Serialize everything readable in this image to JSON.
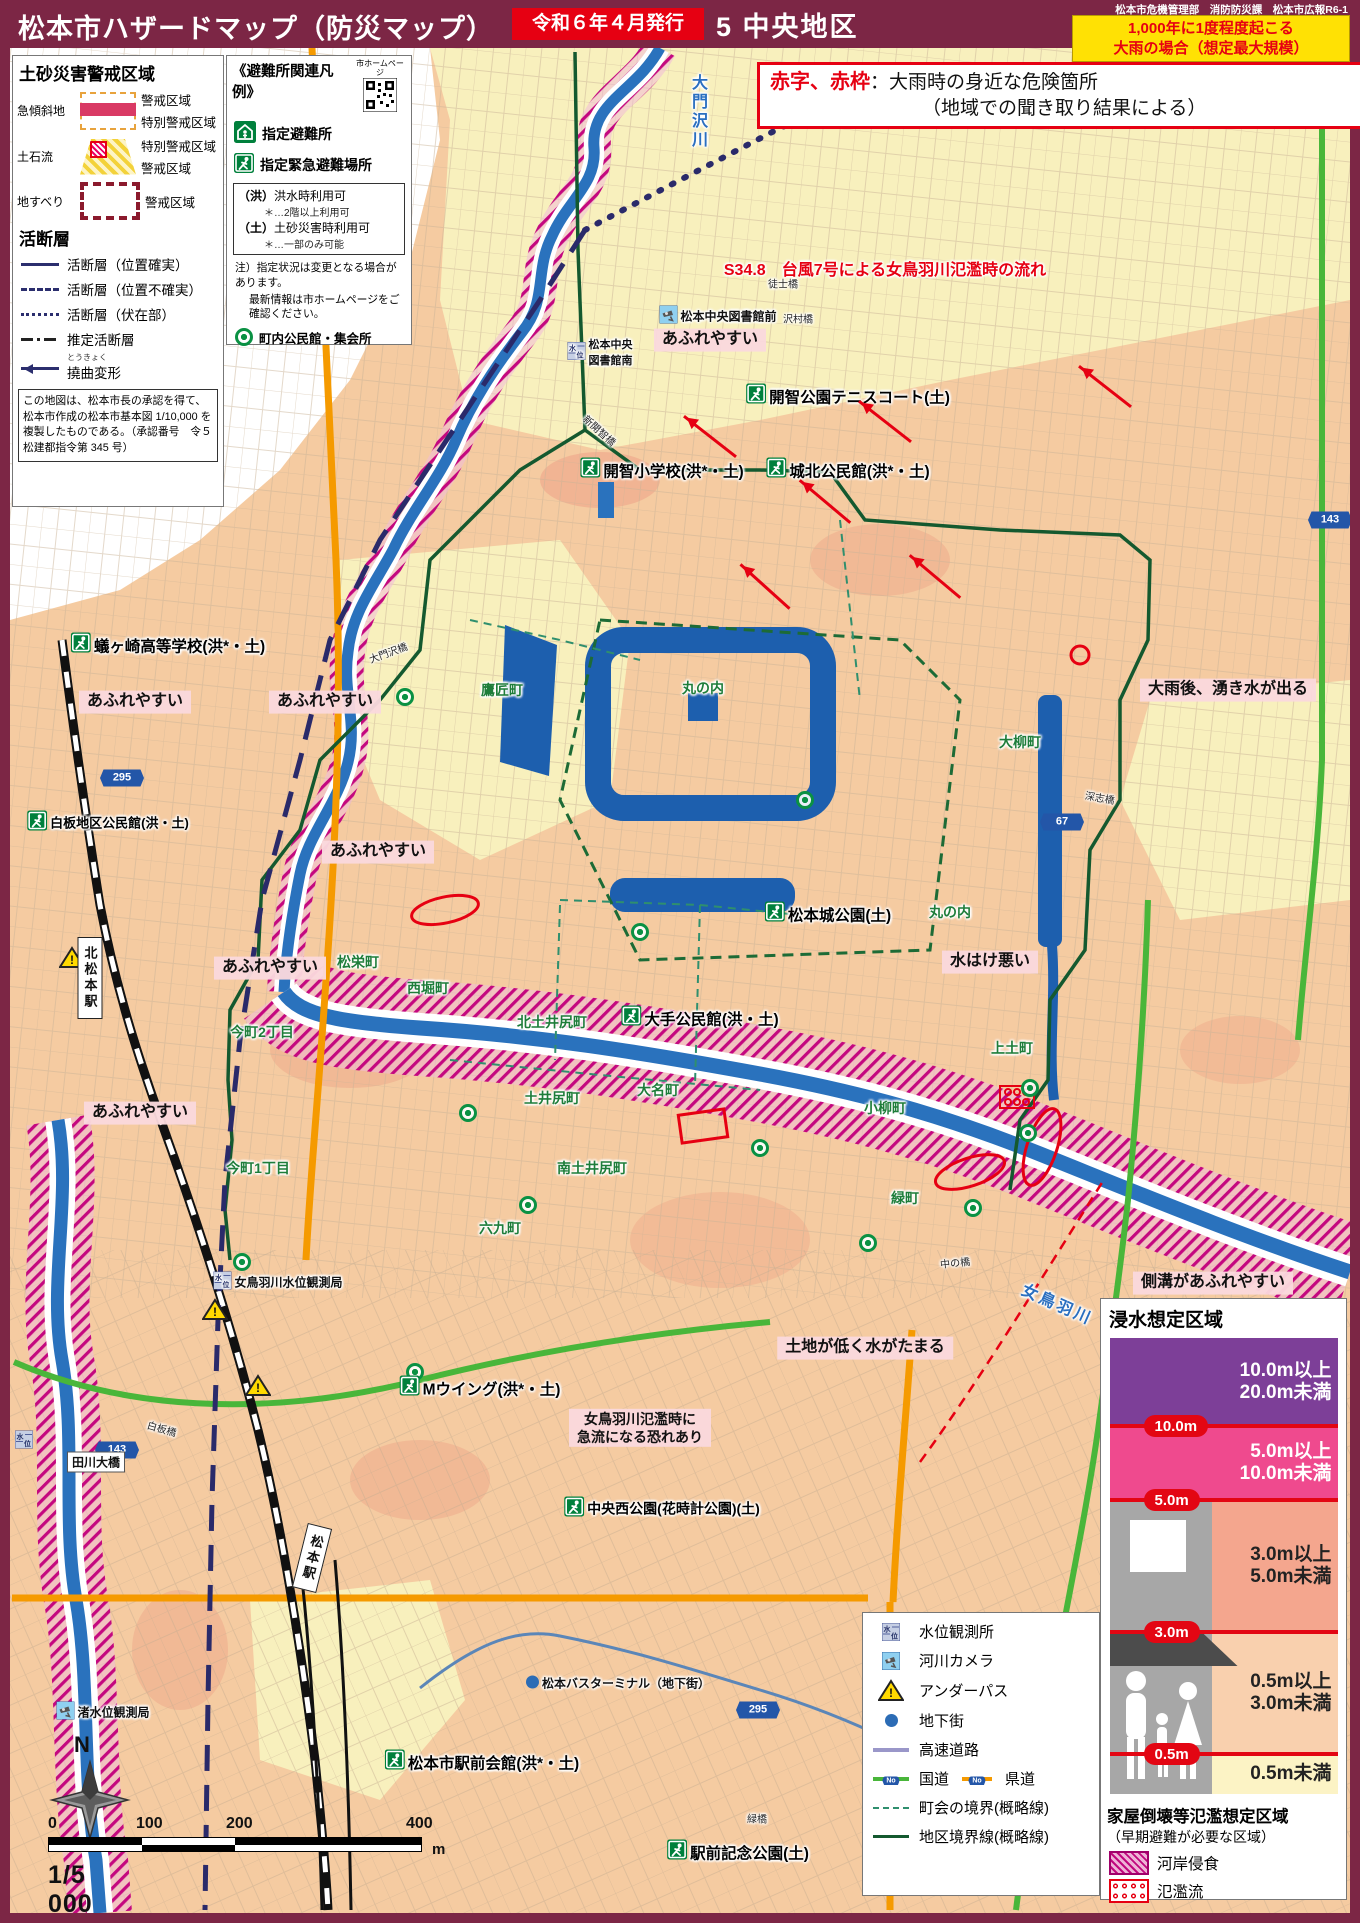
{
  "header": {
    "title": "松本市ハザードマップ（防災マップ）",
    "issue": "令和６年４月発行",
    "district": "5 中央地区",
    "dept": "松本市危機管理部　消防防災課　松本市広報R6-1",
    "scenario_line1": "1,000年に1度程度起こる",
    "scenario_line2": "大雨の場合（想定最大規模）"
  },
  "red_note": {
    "lead": "赤字、赤枠",
    "body": "：大雨時の身近な危険箇所",
    "line2": "（地域での聞き取り結果による）"
  },
  "legend_sediment": {
    "title": "土砂災害警戒区域",
    "rows": [
      {
        "label": "急傾斜地",
        "swatch": "steep",
        "items": [
          "警戒区域",
          "特別警戒区域"
        ]
      },
      {
        "label": "土石流",
        "swatch": "debris",
        "items": [
          "特別警戒区域",
          "警戒区域"
        ]
      },
      {
        "label": "地すべり",
        "swatch": "slide",
        "items": [
          "警戒区域"
        ]
      }
    ],
    "fault_title": "活断層",
    "fault_items": [
      {
        "style": "solid",
        "label": "活断層（位置確実）"
      },
      {
        "style": "dashed",
        "label": "活断層（位置不確実）"
      },
      {
        "style": "dotted",
        "label": "活断層（伏在部）"
      },
      {
        "style": "dashdot",
        "label": "推定活断層"
      },
      {
        "style": "arrow",
        "label": "撓曲変形",
        "ruby": "とうきょく"
      }
    ],
    "note": "この地図は、松本市長の承認を得て、松本市作成の松本市基本図 1/10,000 を複製したものである。（承認番号　令５松建都指令第 345 号）"
  },
  "legend_shelter": {
    "title": "《避難所関連凡例》",
    "qr_label": "市ホームページ",
    "items": [
      {
        "icon": "house",
        "label": "指定避難所"
      },
      {
        "icon": "shelter",
        "label": "指定緊急避難場所"
      }
    ],
    "usage": [
      {
        "key": "（洪）",
        "label": "洪水時利用可",
        "note": "＊…2階以上利用可"
      },
      {
        "key": "（土）",
        "label": "土砂災害時利用可",
        "note": "＊…一部のみ可能"
      }
    ],
    "note1": "注）指定状況は変更となる場合があります。",
    "note2": "最新情報は市ホームページをご確認ください。",
    "community_label": "町内公民館・集会所"
  },
  "flood_legend": {
    "title": "浸水想定区域",
    "bands": [
      {
        "color": "#7d3f98",
        "h": 88,
        "text1": "10.0m以上",
        "text2": "20.0m未満",
        "dark": false,
        "marker": "10.0m"
      },
      {
        "color": "#ef4a8e",
        "h": 74,
        "text1": "5.0m以上",
        "text2": "10.0m未満",
        "dark": false,
        "marker": "5.0m"
      },
      {
        "color": "#f4a68e",
        "h": 132,
        "text1": "3.0m以上",
        "text2": "5.0m未満",
        "dark": true,
        "marker": "3.0m"
      },
      {
        "color": "#f9d0ae",
        "h": 122,
        "text1": "0.5m以上",
        "text2": "3.0m未満",
        "dark": true,
        "marker": "0.5m"
      },
      {
        "color": "#fcf3c5",
        "h": 40,
        "text1": "0.5m未満",
        "text2": "",
        "dark": true
      }
    ],
    "collapse_title": "家屋倒壊等氾濫想定区域",
    "collapse_sub": "（早期避難が必要な区域）",
    "collapse_items": [
      {
        "swatch": "erosion",
        "label": "河岸侵食"
      },
      {
        "swatch": "flow",
        "label": "氾濫流"
      }
    ]
  },
  "symbol_legend": {
    "rows": [
      {
        "icon": "water-level",
        "label": "水位観測所"
      },
      {
        "icon": "river-camera",
        "label": "河川カメラ"
      },
      {
        "icon": "underpass",
        "label": "アンダーパス"
      },
      {
        "icon": "underground",
        "label": "地下街"
      },
      {
        "icon": "expressway",
        "label": "高速道路"
      },
      {
        "icon": "national-route",
        "label": "国道",
        "icon2": "prefectural-route",
        "label2": "県道"
      },
      {
        "icon": "town-boundary",
        "label": "町会の境界(概略線)"
      },
      {
        "icon": "district-boundary",
        "label": "地区境界線(概略線)"
      }
    ]
  },
  "scale": {
    "ticks": [
      "0",
      "100",
      "200",
      "400"
    ],
    "unit": "m",
    "ratio": "1/5 000",
    "north": "N"
  },
  "map_labels": [
    {
      "k": "red",
      "t": "S34.8　台風7号による女鳥羽川氾濫時の流れ",
      "x": 885,
      "y": 268
    },
    {
      "k": "pink",
      "t": "あふれやすい",
      "x": 710,
      "y": 340
    },
    {
      "k": "pink",
      "t": "あふれやすい",
      "x": 135,
      "y": 702
    },
    {
      "k": "pink",
      "t": "あふれやすい",
      "x": 325,
      "y": 702
    },
    {
      "k": "pink",
      "t": "あふれやすい",
      "x": 378,
      "y": 852
    },
    {
      "k": "pink",
      "t": "あふれやすい",
      "x": 270,
      "y": 968
    },
    {
      "k": "pink",
      "t": "あふれやすい",
      "x": 140,
      "y": 1113
    },
    {
      "k": "pink",
      "t": "大雨後、湧き水が出る",
      "x": 1228,
      "y": 690
    },
    {
      "k": "pink",
      "t": "水はけ悪い",
      "x": 990,
      "y": 962
    },
    {
      "k": "pink",
      "t": "側溝があふれやすい",
      "x": 1213,
      "y": 1283
    },
    {
      "k": "pink",
      "t": "土地が低く水がたまる",
      "x": 865,
      "y": 1348
    },
    {
      "k": "pink",
      "t": "女鳥羽川氾濫時に\n急流になる恐れあり",
      "x": 640,
      "y": 1428,
      "s": 14
    },
    {
      "k": "shelter",
      "icon": "shelter",
      "t": "開智公園テニスコート(土)",
      "x": 848,
      "y": 396
    },
    {
      "k": "shelter",
      "icon": "shelter",
      "t": "開智小学校(洪*・土)",
      "x": 662,
      "y": 470
    },
    {
      "k": "shelter",
      "icon": "shelter",
      "t": "城北公民館(洪*・土)",
      "x": 848,
      "y": 470
    },
    {
      "k": "shelter",
      "icon": "shelter",
      "t": "蟻ヶ崎高等学校(洪*・土)",
      "x": 168,
      "y": 645
    },
    {
      "k": "shelter",
      "icon": "shelter",
      "t": "白板地区公民館(洪・土)",
      "x": 108,
      "y": 822,
      "s": 13
    },
    {
      "k": "shelter",
      "icon": "shelter",
      "t": "松本城公園(土)",
      "x": 828,
      "y": 914
    },
    {
      "k": "shelter",
      "icon": "shelter",
      "t": "大手公民館(洪・土)",
      "x": 700,
      "y": 1018
    },
    {
      "k": "shelter",
      "icon": "shelter",
      "t": "Mウイング(洪*・土)",
      "x": 480,
      "y": 1388
    },
    {
      "k": "shelter",
      "icon": "shelter",
      "t": "中央西公園(花時計公園)(土)",
      "x": 662,
      "y": 1508,
      "s": 14
    },
    {
      "k": "shelter",
      "icon": "shelter",
      "t": "松本市駅前会館(洪*・土)",
      "x": 482,
      "y": 1762
    },
    {
      "k": "shelter",
      "icon": "shelter",
      "t": "駅前記念公園(土)",
      "x": 738,
      "y": 1852
    },
    {
      "k": "poi",
      "icon": "camera",
      "t": "松本中央図書館前",
      "x": 718,
      "y": 316
    },
    {
      "k": "poi",
      "icon": "gauge",
      "t": "松本中央\n図書館南",
      "x": 600,
      "y": 352,
      "s": 11
    },
    {
      "k": "poi",
      "icon": "gauge",
      "t": "女鳥羽川水位観測局",
      "x": 278,
      "y": 1282
    },
    {
      "k": "poi",
      "icon": "camera",
      "t": "渚水位観測局",
      "x": 103,
      "y": 1712
    },
    {
      "k": "poi",
      "icon": "dot",
      "t": "松本バスターミナル（地下街）",
      "x": 618,
      "y": 1683
    },
    {
      "k": "town",
      "t": "鷹匠町",
      "x": 502,
      "y": 690
    },
    {
      "k": "town",
      "t": "丸の内",
      "x": 703,
      "y": 688
    },
    {
      "k": "town",
      "t": "大柳町",
      "x": 1020,
      "y": 742
    },
    {
      "k": "town",
      "t": "丸の内",
      "x": 950,
      "y": 912
    },
    {
      "k": "town",
      "t": "松栄町",
      "x": 358,
      "y": 962
    },
    {
      "k": "town",
      "t": "西堀町",
      "x": 428,
      "y": 988
    },
    {
      "k": "town",
      "t": "今町2丁目",
      "x": 262,
      "y": 1032
    },
    {
      "k": "town",
      "t": "北土井尻町",
      "x": 552,
      "y": 1022
    },
    {
      "k": "town",
      "t": "土井尻町",
      "x": 552,
      "y": 1098
    },
    {
      "k": "town",
      "t": "大名町",
      "x": 658,
      "y": 1090
    },
    {
      "k": "town",
      "t": "小柳町",
      "x": 885,
      "y": 1108
    },
    {
      "k": "town",
      "t": "上土町",
      "x": 1012,
      "y": 1048
    },
    {
      "k": "town",
      "t": "今町1丁目",
      "x": 258,
      "y": 1168
    },
    {
      "k": "town",
      "t": "南土井尻町",
      "x": 592,
      "y": 1168
    },
    {
      "k": "town",
      "t": "六九町",
      "x": 500,
      "y": 1228
    },
    {
      "k": "town",
      "t": "緑町",
      "x": 905,
      "y": 1198
    },
    {
      "k": "river",
      "t": "大門沢川",
      "x": 697,
      "y": 112,
      "v": true
    },
    {
      "k": "river",
      "t": "女鳥羽川",
      "x": 1058,
      "y": 1303,
      "rot": 24
    },
    {
      "k": "bridge",
      "t": "徒士橋",
      "x": 783,
      "y": 283
    },
    {
      "k": "bridge",
      "t": "沢村橋",
      "x": 798,
      "y": 318
    },
    {
      "k": "bridge",
      "t": "新開智橋",
      "x": 600,
      "y": 430,
      "rot": 42
    },
    {
      "k": "bridge",
      "t": "大門沢橋",
      "x": 388,
      "y": 652,
      "rot": -20
    },
    {
      "k": "bridge",
      "t": "深志橋",
      "x": 1100,
      "y": 797,
      "rot": 10
    },
    {
      "k": "bridge",
      "t": "中の橋",
      "x": 955,
      "y": 1262,
      "rot": -6
    },
    {
      "k": "bridge",
      "t": "白板橋",
      "x": 162,
      "y": 1428,
      "rot": 16
    },
    {
      "k": "bridge",
      "t": "緑橋",
      "x": 757,
      "y": 1818
    },
    {
      "k": "bridgebox",
      "t": "田川大橋",
      "x": 96,
      "y": 1462
    },
    {
      "k": "station",
      "t": "北松本駅",
      "x": 90,
      "y": 978
    },
    {
      "k": "station",
      "t": "松本駅",
      "x": 312,
      "y": 1558,
      "rot": 14
    }
  ],
  "map_markers": [
    {
      "kind": "shield",
      "t": "295",
      "x": 122,
      "y": 778
    },
    {
      "kind": "shield",
      "t": "67",
      "x": 1062,
      "y": 822
    },
    {
      "kind": "shield",
      "t": "143",
      "x": 1330,
      "y": 520
    },
    {
      "kind": "shield",
      "t": "143",
      "x": 117,
      "y": 1450
    },
    {
      "kind": "shield",
      "t": "295",
      "x": 758,
      "y": 1710
    },
    {
      "kind": "warn",
      "x": 72,
      "y": 960
    },
    {
      "kind": "warn",
      "x": 215,
      "y": 1312
    },
    {
      "kind": "warn",
      "x": 258,
      "y": 1388
    },
    {
      "kind": "gauge",
      "x": 24,
      "y": 1442
    },
    {
      "kind": "community",
      "x": 405,
      "y": 697
    },
    {
      "kind": "community",
      "x": 805,
      "y": 800
    },
    {
      "kind": "community",
      "x": 640,
      "y": 932
    },
    {
      "kind": "community",
      "x": 1030,
      "y": 1088
    },
    {
      "kind": "community",
      "x": 1028,
      "y": 1133
    },
    {
      "kind": "community",
      "x": 973,
      "y": 1208
    },
    {
      "kind": "community",
      "x": 468,
      "y": 1113
    },
    {
      "kind": "community",
      "x": 528,
      "y": 1205
    },
    {
      "kind": "community",
      "x": 760,
      "y": 1148
    },
    {
      "kind": "community",
      "x": 868,
      "y": 1243
    },
    {
      "kind": "community",
      "x": 242,
      "y": 1262
    },
    {
      "kind": "community",
      "x": 415,
      "y": 1372
    }
  ],
  "flow_arrows": [
    {
      "x": 710,
      "y": 435,
      "rot": 38
    },
    {
      "x": 885,
      "y": 420,
      "rot": 38
    },
    {
      "x": 825,
      "y": 500,
      "rot": 40
    },
    {
      "x": 765,
      "y": 585,
      "rot": 42
    },
    {
      "x": 935,
      "y": 575,
      "rot": 40
    },
    {
      "x": 1105,
      "y": 385,
      "rot": 38
    }
  ]
}
